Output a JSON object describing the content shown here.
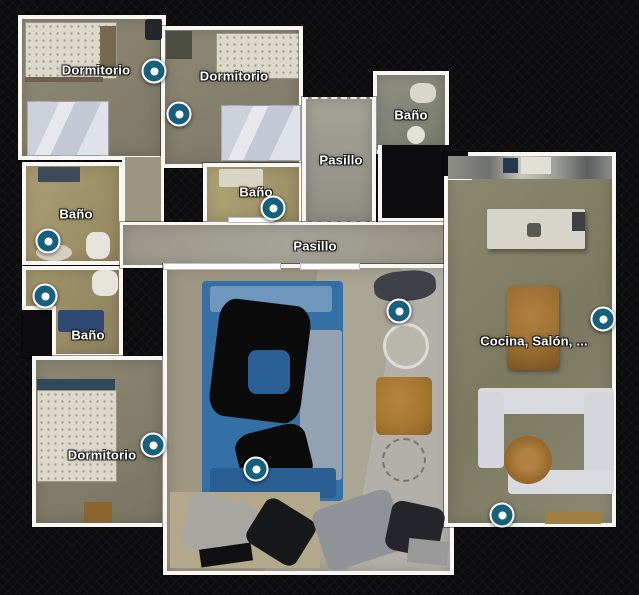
{
  "view": {
    "app": "3d-tour-floorplan-view",
    "background_color": "#0c0c0e",
    "wall_color": "#f7f6f2",
    "label_color": "#ffffff",
    "marker_color": "#16607c"
  },
  "room_labels": [
    {
      "id": "dormitorio-top-left",
      "text": "Dormitorio",
      "x": 96,
      "y": 70
    },
    {
      "id": "dormitorio-top-middle",
      "text": "Dormitorio",
      "x": 234,
      "y": 76
    },
    {
      "id": "bano-top-right",
      "text": "Baño",
      "x": 411,
      "y": 115
    },
    {
      "id": "pasillo-upper",
      "text": "Pasillo",
      "x": 341,
      "y": 160
    },
    {
      "id": "bano-middle",
      "text": "Baño",
      "x": 256,
      "y": 192
    },
    {
      "id": "bano-left-upper",
      "text": "Baño",
      "x": 76,
      "y": 214
    },
    {
      "id": "pasillo-main",
      "text": "Pasillo",
      "x": 315,
      "y": 246
    },
    {
      "id": "bano-left-lower",
      "text": "Baño",
      "x": 88,
      "y": 335
    },
    {
      "id": "cocina-salon",
      "text": "Cocina, Salón, ...",
      "x": 534,
      "y": 341
    },
    {
      "id": "dormitorio-bottom-left",
      "text": "Dormitorio",
      "x": 102,
      "y": 455
    }
  ],
  "waypoints": [
    {
      "id": "1",
      "x": 154,
      "y": 71
    },
    {
      "id": "2",
      "x": 179,
      "y": 114
    },
    {
      "id": "3",
      "x": 273,
      "y": 208
    },
    {
      "id": "4",
      "x": 48,
      "y": 241
    },
    {
      "id": "5",
      "x": 45,
      "y": 296
    },
    {
      "id": "6",
      "x": 399,
      "y": 311
    },
    {
      "id": "7",
      "x": 603,
      "y": 319
    },
    {
      "id": "8",
      "x": 153,
      "y": 445
    },
    {
      "id": "9",
      "x": 256,
      "y": 469
    },
    {
      "id": "10",
      "x": 502,
      "y": 515
    }
  ]
}
